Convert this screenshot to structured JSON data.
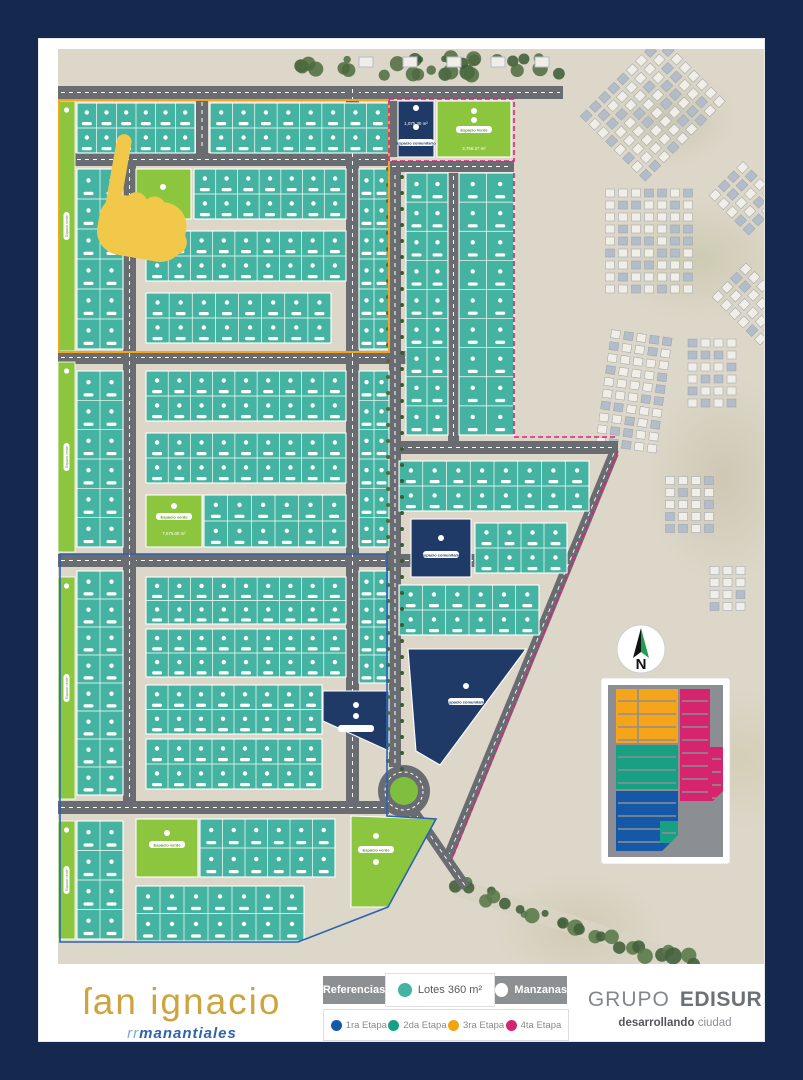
{
  "branding": {
    "project_name": "ſan ignacio",
    "project_sub_prefix": "rr",
    "project_sub": "manantiales",
    "company_1": "GRUPO",
    "company_2": "EDISUR",
    "tagline_bold": "desarrollando",
    "tagline_light": "ciudad"
  },
  "legend": {
    "referencias": "Referencias",
    "lotes": "Lotes 360 m²",
    "manzanas": "Manzanas",
    "etapas": [
      {
        "label": "1ra Etapa",
        "color": "#1558a7"
      },
      {
        "label": "2da Etapa",
        "color": "#16a085"
      },
      {
        "label": "3ra Etapa",
        "color": "#f2a40e"
      },
      {
        "label": "4ta Etapa",
        "color": "#d6246e"
      }
    ]
  },
  "compass": {
    "letter": "N",
    "cx": 583,
    "cy": 600,
    "r": 24
  },
  "map": {
    "labels": {
      "espacio_verde": "Espacio verde",
      "espacio_verde_cap": "Espacio Verde",
      "espacio_comunitario": "Espacio comunitario",
      "area_navy_top": "1,075.30 m²",
      "area_green_top": "3,758.27 m²",
      "area_green_mid": "7,675.00 m²"
    },
    "colors": {
      "lot": "#44b3a1",
      "lotLine": "#ffffff",
      "green": "#8cc63e",
      "navy": "#1f3a66",
      "road": "#696d71",
      "roadLine": "#ffffff",
      "tree": "#4c6b3e",
      "treeDark": "#3a5a34",
      "orange": "#f6a41a",
      "pink": "#e0207c",
      "blue": "#2b62b5",
      "teal": "#17a084",
      "insetBg": "#8b8f93",
      "hand": "#f2c84b",
      "house": "#f0eee6",
      "houseShadow": "#b3bcc9"
    },
    "roads": {
      "h": [
        [
          0,
          37,
          505,
          13
        ],
        [
          0,
          104,
          331,
          13
        ],
        [
          0,
          302,
          456,
          13
        ],
        [
          0,
          505,
          456,
          13
        ],
        [
          0,
          752,
          331,
          13
        ],
        [
          331,
          112,
          125,
          11
        ],
        [
          331,
          392,
          229,
          13
        ]
      ],
      "v": [
        [
          138,
          50,
          12,
          54
        ],
        [
          65,
          117,
          13,
          635
        ],
        [
          288,
          37,
          13,
          715
        ],
        [
          331,
          123,
          12,
          595
        ],
        [
          390,
          124,
          11,
          268
        ]
      ],
      "stubs": [
        [
          332,
          52,
          8,
          56
        ]
      ],
      "diag": [
        [
          556,
          404,
          390,
          808
        ],
        [
          350,
          754,
          408,
          838
        ]
      ]
    },
    "roundabout": {
      "cx": 346,
      "cy": 742,
      "rOuter": 26,
      "rDash": 19,
      "rGreen": 14
    },
    "strips": [
      [
        0,
        52,
        17,
        250
      ],
      [
        0,
        313,
        17,
        190
      ],
      [
        0,
        528,
        17,
        222
      ],
      [
        0,
        772,
        17,
        118
      ]
    ],
    "blocks": [
      [
        19,
        54,
        118,
        50,
        6,
        2
      ],
      [
        152,
        54,
        179,
        50,
        8,
        2
      ],
      [
        19,
        120,
        46,
        180,
        2,
        6
      ],
      [
        136,
        120,
        152,
        50,
        7,
        2
      ],
      [
        301,
        120,
        30,
        180,
        2,
        6
      ],
      [
        88,
        182,
        200,
        50,
        9,
        2
      ],
      [
        88,
        244,
        185,
        50,
        8,
        2
      ],
      [
        19,
        322,
        46,
        176,
        2,
        6
      ],
      [
        88,
        322,
        200,
        50,
        9,
        2
      ],
      [
        88,
        384,
        200,
        50,
        9,
        2
      ],
      [
        146,
        446,
        142,
        52,
        6,
        2
      ],
      [
        301,
        322,
        30,
        176,
        2,
        6
      ],
      [
        348,
        124,
        42,
        262,
        2,
        9
      ],
      [
        401,
        124,
        55,
        262,
        2,
        9
      ],
      [
        341,
        412,
        190,
        50,
        8,
        2
      ],
      [
        417,
        474,
        92,
        50,
        4,
        2
      ],
      [
        341,
        536,
        140,
        50,
        6,
        2
      ],
      [
        19,
        522,
        46,
        224,
        2,
        8
      ],
      [
        19,
        772,
        46,
        118,
        2,
        4
      ],
      [
        88,
        528,
        200,
        47,
        9,
        2
      ],
      [
        88,
        580,
        200,
        48,
        9,
        2
      ],
      [
        88,
        636,
        176,
        49,
        8,
        2
      ],
      [
        88,
        690,
        176,
        50,
        8,
        2
      ],
      [
        301,
        522,
        30,
        112,
        2,
        4
      ],
      [
        142,
        770,
        135,
        58,
        6,
        2
      ],
      [
        78,
        837,
        168,
        55,
        7,
        2
      ]
    ],
    "greens": [
      {
        "r": [
          78,
          120,
          55,
          50
        ],
        "badges": [
          [
            105,
            138
          ]
        ]
      },
      {
        "r": [
          88,
          446,
          56,
          52
        ],
        "pill": [
          116,
          468
        ],
        "pillText": "espacio_verde",
        "area": [
          116,
          478
        ],
        "areaText": "area_green_mid",
        "badges": [
          [
            116,
            457
          ]
        ]
      },
      {
        "r": [
          78,
          770,
          62,
          58
        ],
        "pill": [
          109,
          796
        ],
        "pillText": "espacio_verde",
        "badges": [
          [
            109,
            784
          ]
        ]
      },
      {
        "r": [
          379,
          52,
          74,
          56
        ],
        "pill": [
          416,
          81
        ],
        "pillText": "espacio_verde_cap",
        "area": [
          416,
          93
        ],
        "areaText": "area_green_top",
        "badges": [
          [
            416,
            62
          ],
          [
            416,
            71
          ]
        ]
      },
      {
        "poly": "293,767 378,770 330,858 293,858",
        "pill": [
          318,
          801
        ],
        "pillText": "espacio_verde",
        "badges": [
          [
            318,
            787
          ],
          [
            318,
            813
          ]
        ]
      }
    ],
    "navies": [
      {
        "r": [
          340,
          52,
          36,
          56
        ],
        "pill": [
          358,
          94
        ],
        "pillText": "espacio_comunitario",
        "area": [
          358,
          68
        ],
        "areaText": "area_navy_top",
        "badges": [
          [
            358,
            59
          ],
          [
            358,
            78
          ]
        ]
      },
      {
        "r": [
          353,
          470,
          60,
          58
        ],
        "pill": [
          383,
          506
        ],
        "pillText": "espacio_comunitario",
        "badges": [
          [
            383,
            489
          ]
        ]
      },
      {
        "poly": "265,642 331,642 331,702 265,672",
        "pill": [
          298,
          680
        ],
        "badges": [
          [
            298,
            656
          ],
          [
            298,
            667
          ]
        ]
      },
      {
        "poly": "350,600 468,600 382,716 358,702",
        "pill": [
          408,
          653
        ],
        "pillText": "espacio_comunitario",
        "badges": [
          [
            408,
            637
          ]
        ]
      }
    ],
    "outlines": {
      "orange": [
        1,
        51,
        330,
        252
      ],
      "pink": [
        "M331,50 H456 V112 H331 Z",
        "M456,124 V388 H557",
        "M560,402 L393,812"
      ],
      "blue": "2,505 329,505 329,767 378,770 330,858 240,893 2,893"
    },
    "clusters": [
      [
        600,
        60,
        120,
        100,
        -45
      ],
      [
        690,
        150,
        50,
        60,
        -45
      ],
      [
        595,
        195,
        95,
        110,
        0
      ],
      [
        700,
        255,
        55,
        75,
        -45
      ],
      [
        580,
        345,
        70,
        120,
        8
      ],
      [
        660,
        330,
        60,
        80,
        0
      ],
      [
        635,
        460,
        55,
        65,
        0
      ],
      [
        672,
        545,
        40,
        55,
        0
      ]
    ],
    "treeStrip": {
      "x": 243,
      "y": 2,
      "w": 258,
      "h": 32,
      "houses": 5
    },
    "avenue": {
      "x1": 330,
      "x2": 344,
      "y1": 120,
      "y2": 712,
      "step": 16
    },
    "greenway": {
      "x1": 398,
      "y1": 838,
      "x2": 632,
      "y2": 914
    },
    "inset": {
      "card": [
        543,
        629,
        129,
        186
      ],
      "inner": [
        550,
        636,
        115,
        172
      ],
      "rects": [
        {
          "x": 558,
          "y": 640,
          "w": 62,
          "h": 54,
          "c": "orange"
        },
        {
          "x": 622,
          "y": 640,
          "w": 30,
          "h": 112,
          "c": "pink"
        },
        {
          "x": 652,
          "y": 698,
          "w": 13,
          "h": 54,
          "c": "pink"
        },
        {
          "x": 558,
          "y": 696,
          "w": 62,
          "h": 44,
          "c": "teal"
        },
        {
          "x": 558,
          "y": 742,
          "w": 62,
          "h": 60,
          "c": "blue"
        },
        {
          "x": 602,
          "y": 772,
          "w": 18,
          "h": 22,
          "c": "teal"
        }
      ],
      "cut": "598,808 665,808 665,742"
    },
    "hand": {
      "x": 60,
      "y": 84,
      "rot": 10
    }
  }
}
